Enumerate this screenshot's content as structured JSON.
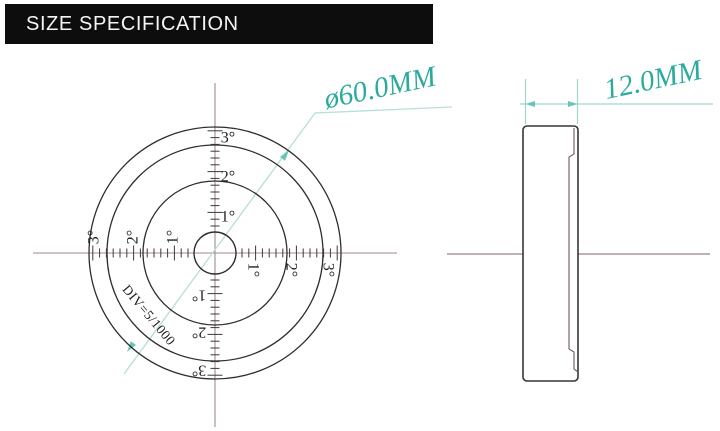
{
  "header": {
    "title": "SIZE SPECIFICATION"
  },
  "front_view": {
    "degree_labels": {
      "d1": "1°",
      "d2": "2°",
      "d3": "3°"
    },
    "division_label": "DIV=5/1000",
    "diameter_label": "ø60.0MM"
  },
  "side_view": {
    "thickness_label": "12.0MM"
  },
  "colors": {
    "header_bg": "#0D0D0D",
    "header_text": "#F5F5F5",
    "dimension_teal": "#2BAB9E",
    "leader_light_teal": "#B7DED8",
    "centerline": "#A18B8B",
    "drawing_outline": "#2E2E2E"
  }
}
